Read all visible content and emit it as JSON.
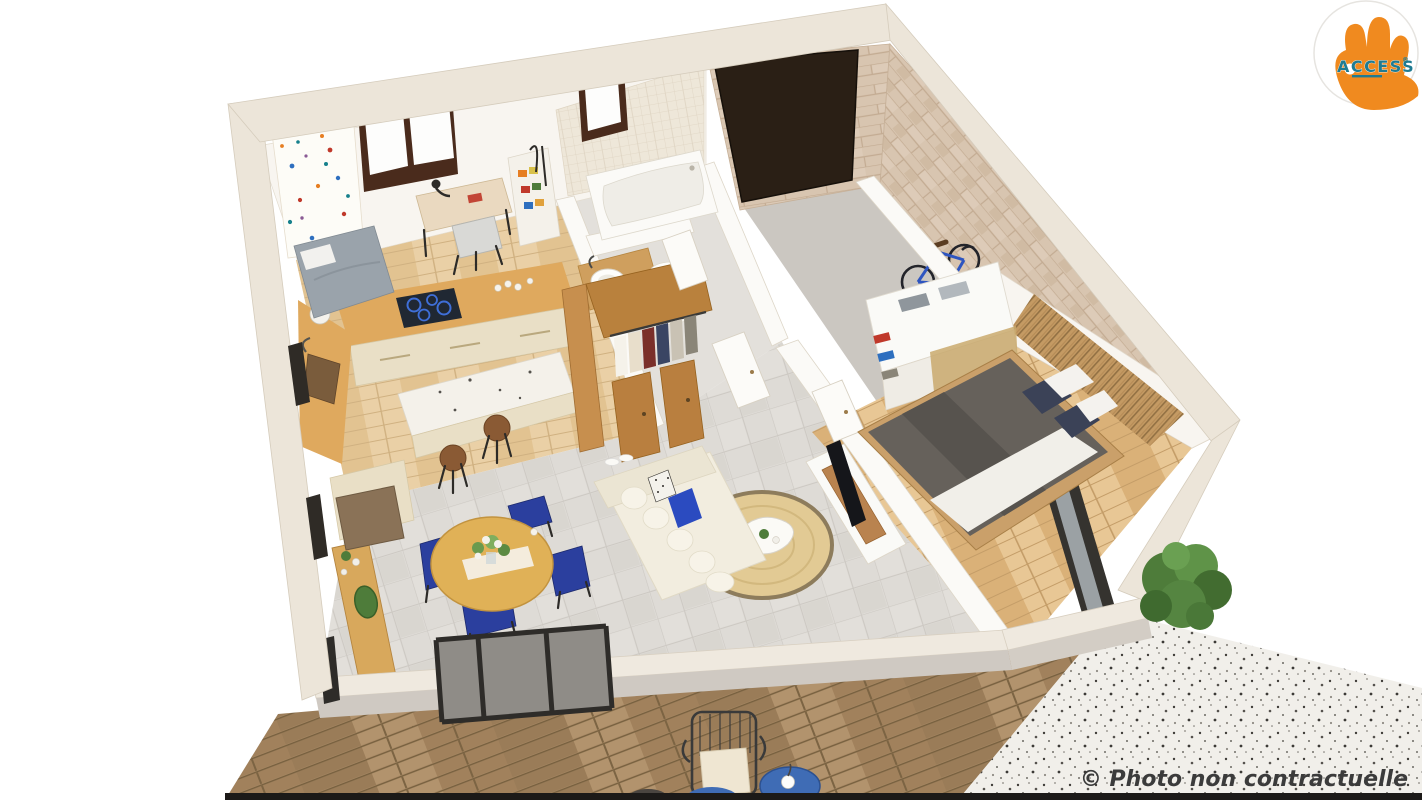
{
  "canvas": {
    "width": 1422,
    "height": 800,
    "background": "#FFFFFF"
  },
  "logo": {
    "brand": "ACCESS",
    "mark": "®"
  },
  "watermark": {
    "text": "© Photo non contractuelle"
  },
  "palette": {
    "accent_orange": "#F08A1F",
    "accent_teal": "#1F7B92",
    "watermark_gray": "#3B3B3B",
    "wall_white": "#F8F5F0",
    "wall_cut_stone": "#ECE5D9",
    "brick_stone": "#D8C5B0",
    "garage_door": "#2A1F15",
    "garage_floor": "#CBC7C1",
    "tile_floor": "#DEDBD6",
    "wood_floor": "#E3BF8E",
    "kitchen_wood": "#DFA95E",
    "cabinet_cream": "#E9DFC6",
    "cooktop_black": "#202833",
    "cooktop_ring_blue": "#3F6FD8",
    "sofa_cream": "#F2EDDF",
    "pillow_blue": "#2B4BC0",
    "rug_jute": "#E2CA94",
    "dining_table": "#E0B157",
    "chair_blue": "#2B3F9E",
    "bed_duvet": "#66615B",
    "pillow_navy": "#3B4257",
    "slat_wood": "#C49A63",
    "deck_wood": "#A58662",
    "terrazzo": "#F1EFEA",
    "plant_green": "#4E7C3A",
    "bike_blue": "#2E55C0",
    "window_frame": "#4A2B1C",
    "glass_dark": "#2E2C29"
  },
  "scene": {
    "type": "3d-floor-plan-render",
    "view": "aerial-cutaway",
    "rooms": [
      {
        "name": "kids-bedroom-office",
        "items": [
          "single-bed",
          "desk",
          "desk-lamp",
          "desk-chair",
          "patterned-wallpaper",
          "dark-frame-window"
        ]
      },
      {
        "name": "kitchen",
        "items": [
          "l-shaped-wood-counter",
          "induction-cooktop",
          "sink",
          "food-processor",
          "terrazzo-island",
          "two-wood-stools",
          "cream-cabinets"
        ]
      },
      {
        "name": "bathroom",
        "items": [
          "bathtub",
          "round-vessel-sink",
          "beige-tiled-wall",
          "small-window",
          "water-heater"
        ]
      },
      {
        "name": "hallway-dressing",
        "items": [
          "wood-wardrobe",
          "hanging-clothes",
          "open-white-doors",
          "storage-shelves"
        ]
      },
      {
        "name": "garage",
        "items": [
          "dark-garage-door",
          "stone-brick-walls",
          "blue-bicycle",
          "gray-concrete-floor"
        ]
      },
      {
        "name": "master-bedroom",
        "items": [
          "double-bed",
          "gray-duvet",
          "navy-pillows",
          "white-sliding-wardrobe",
          "folded-towels",
          "nightstand",
          "reading-lamp",
          "wood-slat-accent-wall",
          "sliding-glass-door"
        ]
      },
      {
        "name": "living-dining",
        "items": [
          "cream-sofa",
          "blue-cushion",
          "round-jute-rug",
          "organic-coffee-table",
          "tv",
          "tv-console",
          "round-dining-table",
          "four-blue-chairs",
          "wood-sideboard",
          "doormat",
          "flower-centerpiece"
        ]
      },
      {
        "name": "deck-terrace",
        "items": [
          "diagonal-wood-decking",
          "wire-armchair-with-cushion",
          "blue-side-tables"
        ]
      },
      {
        "name": "patio",
        "items": [
          "gravel-terrazzo-ground",
          "green-shrub"
        ]
      }
    ]
  }
}
